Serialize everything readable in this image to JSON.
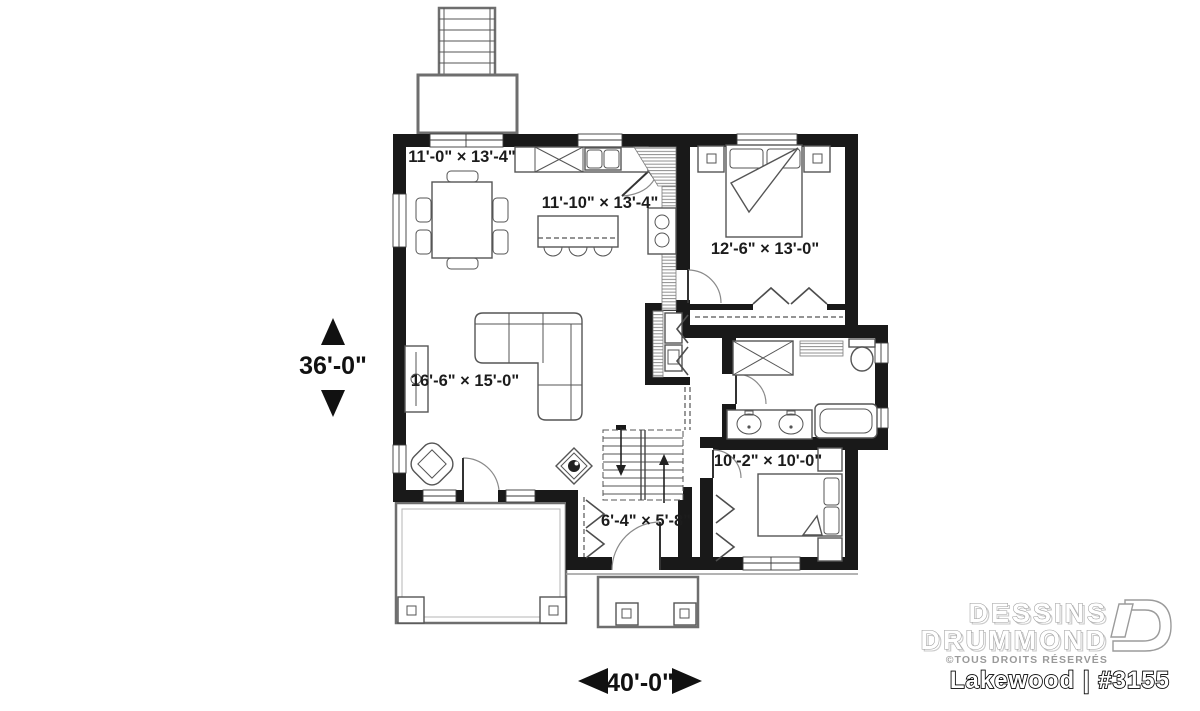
{
  "footer": {
    "brand_line1": "DESSINS",
    "brand_line2": "DRUMMOND",
    "rights_notice": "©TOUS DROITS RÉSERVÉS",
    "plan_name": "Lakewood | #3155"
  },
  "dimensions": {
    "depth": "36'-0\"",
    "width": "40'-0\""
  },
  "rooms": {
    "dining": {
      "dims": "11'-0\" × 13'-4\""
    },
    "kitchen": {
      "dims": "11'-10\" × 13'-4\""
    },
    "master_bedroom": {
      "dims": "12'-6\" × 13'-0\""
    },
    "living_room": {
      "dims": "16'-6\" × 15'-0\""
    },
    "bedroom_2": {
      "dims": "10'-2\" × 10'-0\""
    },
    "entry": {
      "dims": "6'-4\" × 5'-8\""
    }
  },
  "colors": {
    "wall": "#191919",
    "furniture_line": "#555555",
    "hatch": "#8f8f8f",
    "label_text": "#1c1c1c",
    "brand_gray": "#9b9b9b"
  }
}
